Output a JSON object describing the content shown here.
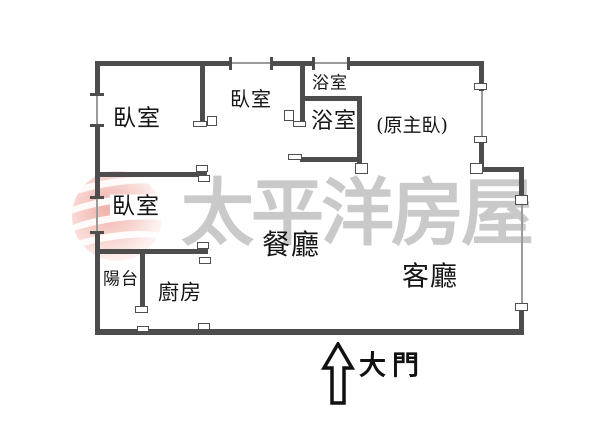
{
  "plan": {
    "type": "apartment-floor-plan",
    "orientation_note": "entrance arrow points up into living room"
  },
  "rooms": {
    "bedroom_top_left": {
      "label": "臥室"
    },
    "bedroom_middle": {
      "label": "臥室"
    },
    "bedroom_lower_left": {
      "label": "臥室"
    },
    "bathroom_upper": {
      "label": "浴室"
    },
    "bathroom_lower": {
      "label": "浴室"
    },
    "master_note": {
      "label": "(原主臥)"
    },
    "dining": {
      "label": "餐廳"
    },
    "living": {
      "label": "客廳"
    },
    "balcony": {
      "label": "陽台"
    },
    "kitchen": {
      "label": "廚房"
    }
  },
  "entrance": {
    "label": "大門"
  },
  "watermark": {
    "text": "太平洋房屋"
  },
  "colors": {
    "wall": "#4d4d4d",
    "window_line": "#9b9b9b",
    "watermark_text": "#c9c9c9",
    "logo_pink": "#e87d73",
    "label_text": "#151515"
  }
}
